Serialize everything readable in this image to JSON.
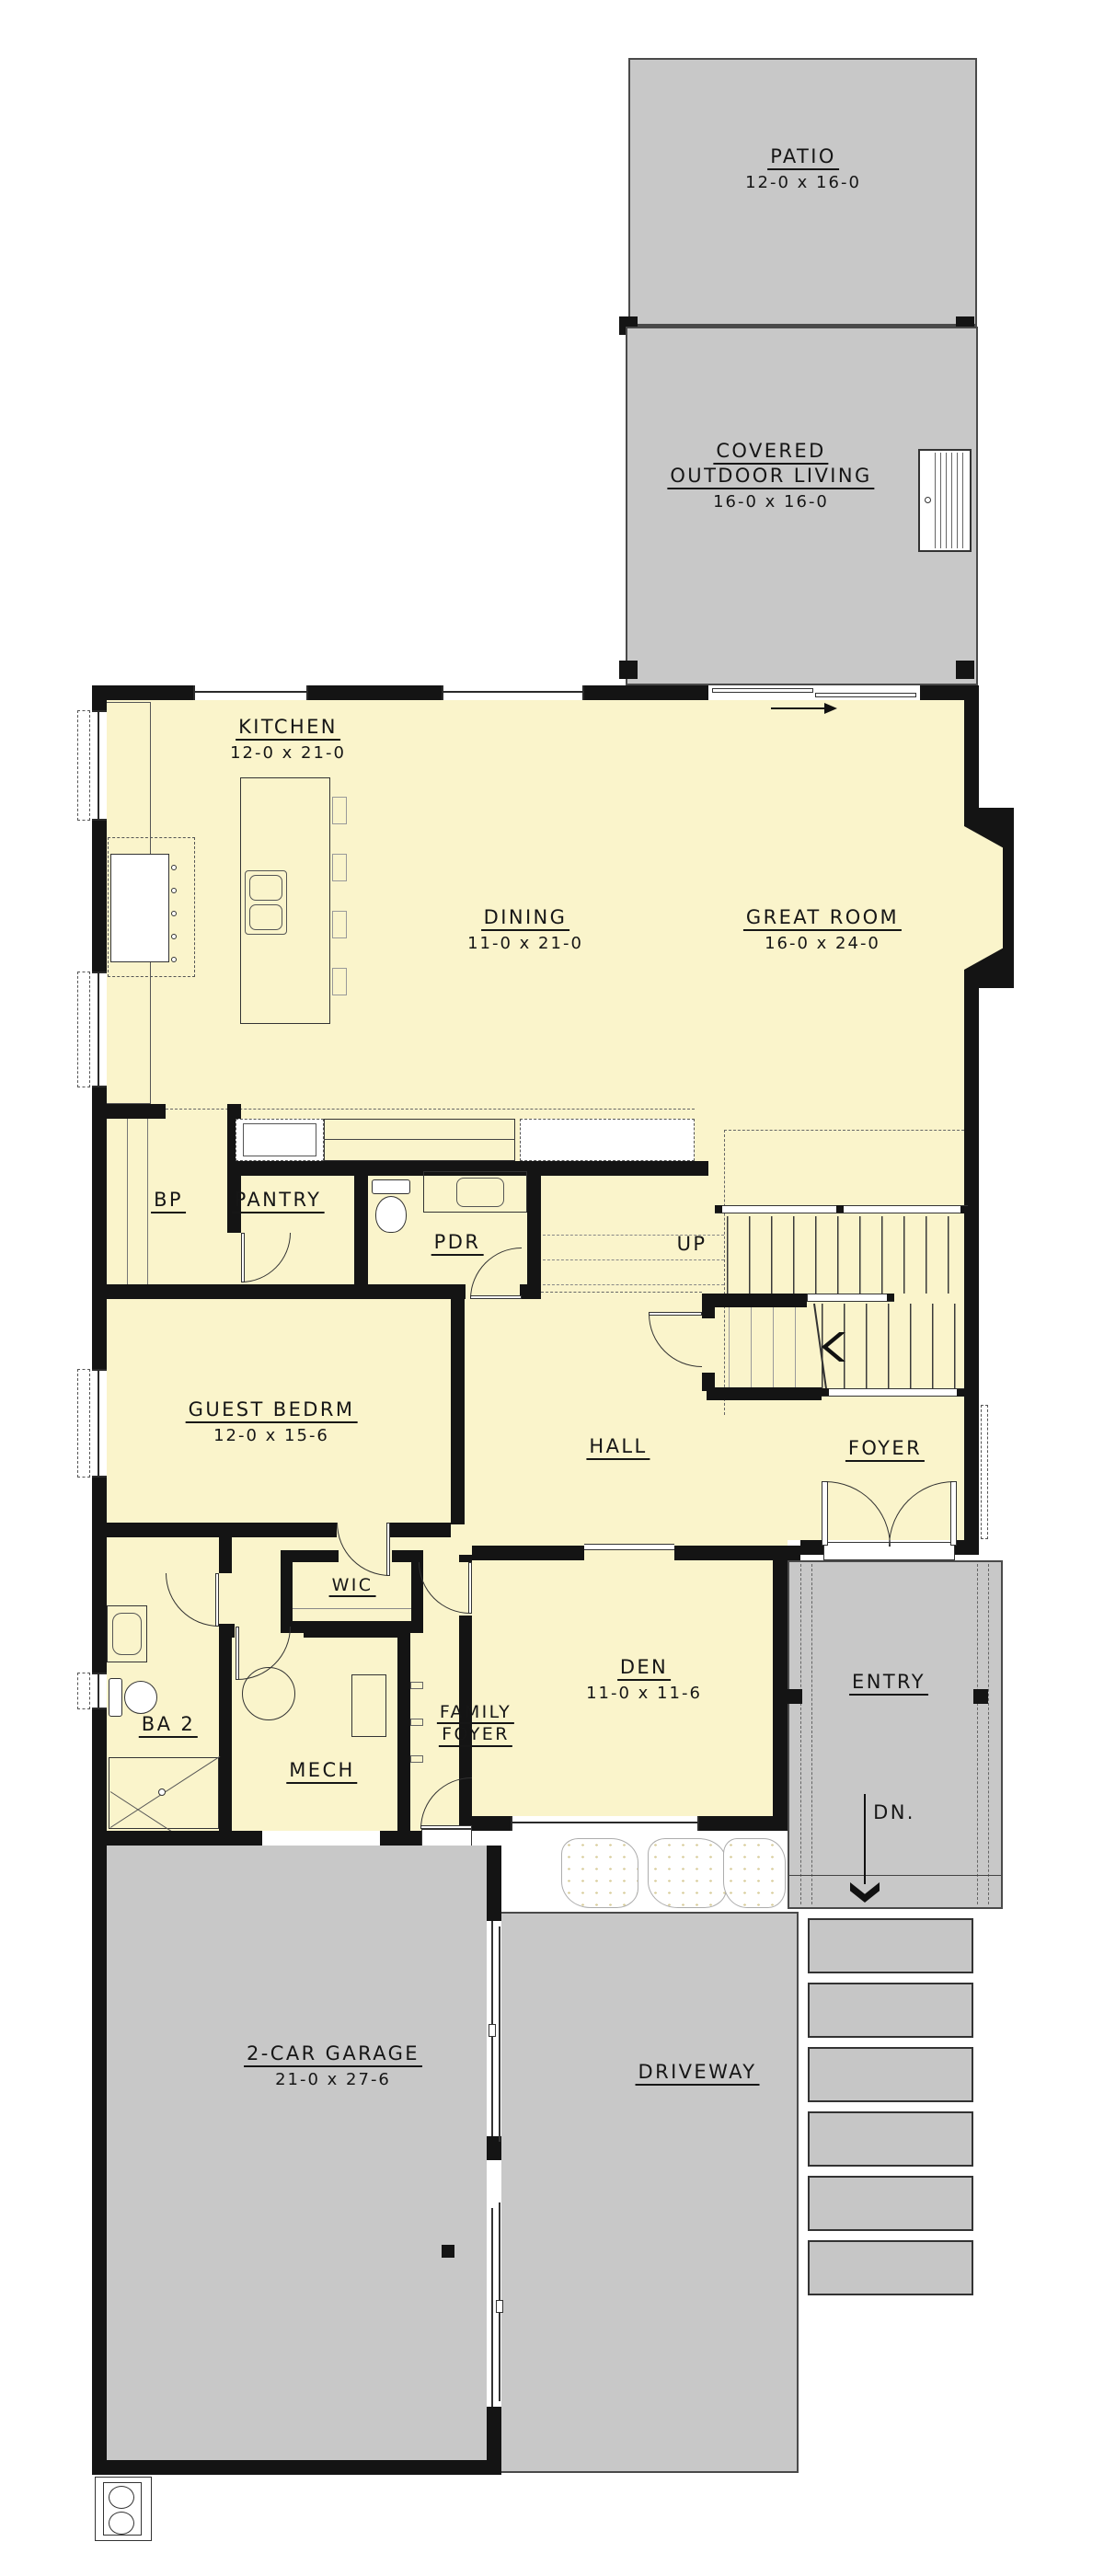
{
  "plan": {
    "outdoor": {
      "patio": {
        "name": "PATIO",
        "dims": "12-0 x 16-0"
      },
      "covered_outdoor_living": {
        "name": "COVERED",
        "name2": "OUTDOOR LIVING",
        "dims": "16-0 x 16-0"
      },
      "entry": {
        "name": "ENTRY"
      },
      "driveway": {
        "name": "DRIVEWAY"
      }
    },
    "rooms": {
      "kitchen": {
        "name": "KITCHEN",
        "dims": "12-0 x 21-0"
      },
      "dining": {
        "name": "DINING",
        "dims": "11-0 x 21-0"
      },
      "great_room": {
        "name": "GREAT ROOM",
        "dims": "16-0 x 24-0"
      },
      "bp": {
        "name": "BP"
      },
      "pantry": {
        "name": "PANTRY"
      },
      "pdr": {
        "name": "PDR"
      },
      "guest_bedrm": {
        "name": "GUEST BEDRM",
        "dims": "12-0 x 15-6"
      },
      "hall": {
        "name": "HALL"
      },
      "foyer": {
        "name": "FOYER"
      },
      "wic": {
        "name": "WIC"
      },
      "ba2": {
        "name": "BA 2"
      },
      "mech": {
        "name": "MECH"
      },
      "family_foyer": {
        "name": "FAMILY",
        "name2": "FOYER"
      },
      "den": {
        "name": "DEN",
        "dims": "11-0 x 11-6"
      },
      "garage": {
        "name": "2-CAR GARAGE",
        "dims": "21-0 x 27-6"
      }
    },
    "annotations": {
      "up": "UP",
      "dn": "DN."
    },
    "colors": {
      "interior": "#FAF4CB",
      "outdoor": "#C8C8C8",
      "wall": "#141414",
      "line": "#333333",
      "steps": "#C6C6C6"
    }
  }
}
